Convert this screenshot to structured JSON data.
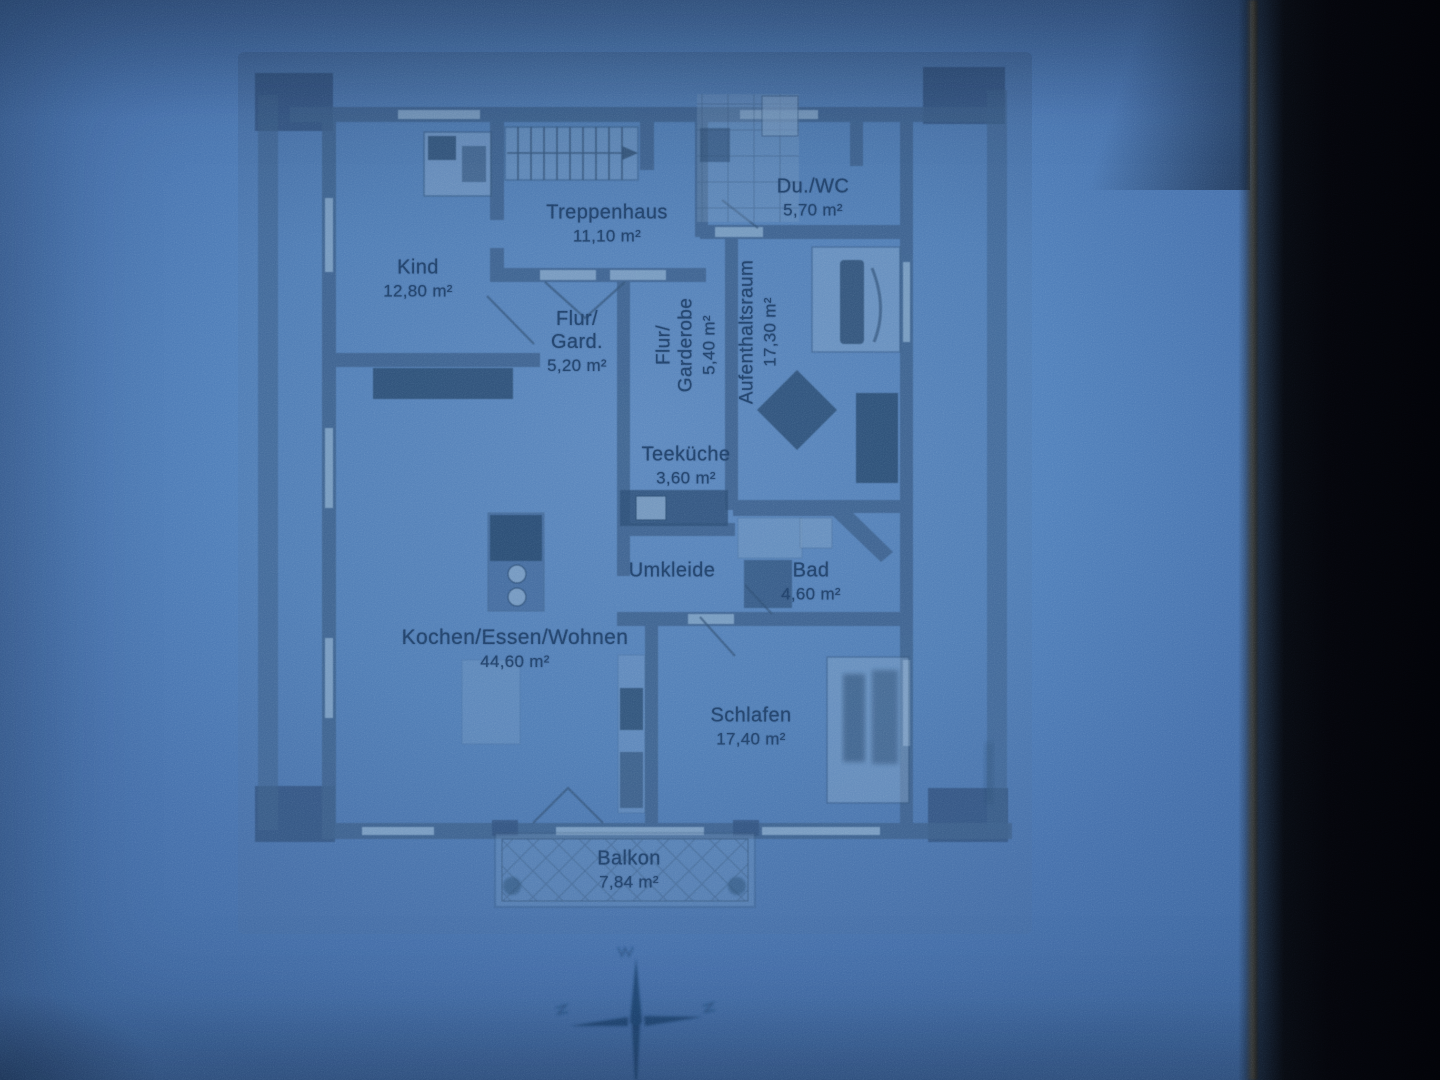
{
  "photo": {
    "subject": "apartment floor plan blueprint"
  },
  "colors": {
    "paper_blue": "#4f7fba",
    "ink": "#1c3e6a",
    "wall": "#3a5f8c",
    "furniture_dark": "#24466d",
    "tile_light": "#7da2ca",
    "background_dark": "#04050a"
  },
  "floorplan": {
    "rooms": [
      {
        "name": "treppenhaus",
        "label": "Treppenhaus",
        "area": "11,10 m²"
      },
      {
        "name": "du-wc",
        "label": "Du./WC",
        "area": "5,70 m²"
      },
      {
        "name": "kind",
        "label": "Kind",
        "area": "12,80 m²"
      },
      {
        "name": "flur-gard",
        "label": "Flur/\nGard.",
        "area": "5,20 m²"
      },
      {
        "name": "flur-garderobe",
        "label": "Flur/\nGarderobe",
        "area": "5,40 m²"
      },
      {
        "name": "aufenthaltsraum",
        "label": "Aufenthaltsraum",
        "area": "17,30 m²"
      },
      {
        "name": "teekueche",
        "label": "Teeküche",
        "area": "3,60 m²"
      },
      {
        "name": "umkleide",
        "label": "Umkleide",
        "area": ""
      },
      {
        "name": "bad",
        "label": "Bad",
        "area": "4,60 m²"
      },
      {
        "name": "kochen-essen-wohnen",
        "label": "Kochen/Essen/Wohnen",
        "area": "44,60 m²"
      },
      {
        "name": "schlafen",
        "label": "Schlafen",
        "area": "17,40 m²"
      },
      {
        "name": "balkon",
        "label": "Balkon",
        "area": "7,84 m²"
      }
    ],
    "compass": {
      "icon": "compass-rose-icon"
    }
  }
}
